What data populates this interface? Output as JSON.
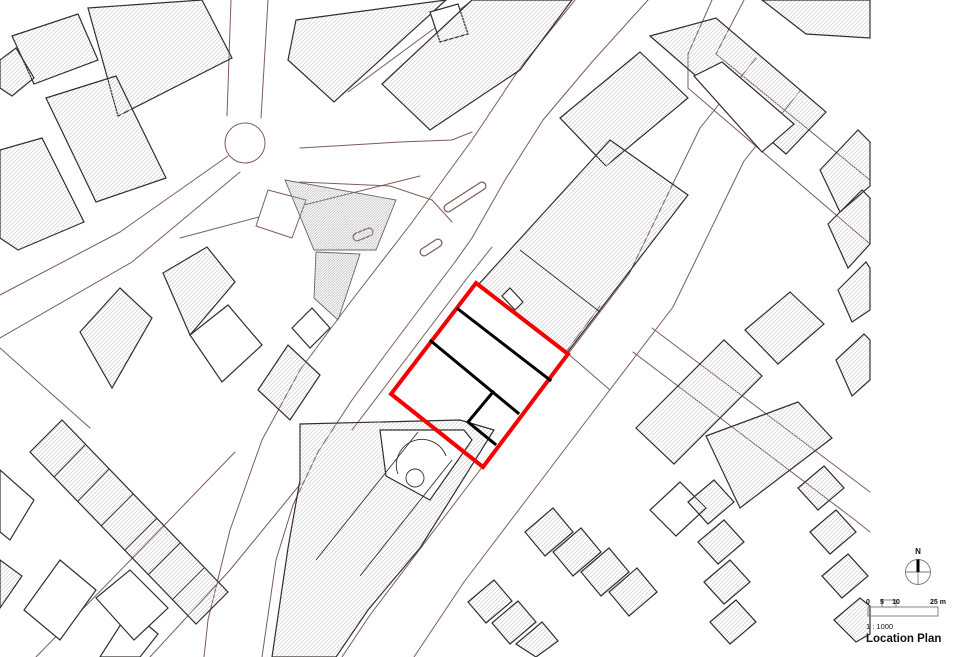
{
  "legend": {
    "north_label": "N",
    "ticks": [
      "0",
      "5",
      "10"
    ],
    "unit": "25 m",
    "ratio": "1 : 1000",
    "title": "Location Plan"
  },
  "site": {
    "boundary_color": "#f40000",
    "division_color": "#000000"
  },
  "map": {
    "building_outline_color": "#332e2e",
    "parcel_line_color": "#7d5c56",
    "shapes": [
      {
        "n": "road-main-nw-edge",
        "t": "pl",
        "c": "p",
        "p": "575,0 520,68 472,140 410,225 352,300 300,370 262,440 230,530 208,620 204,657"
      },
      {
        "n": "road-main-se-edge",
        "t": "pl",
        "c": "p",
        "p": "648,0 592,62 543,120 505,180 472,238 455,262 430,295 385,355 352,400 318,452 293,505 276,560 262,657"
      },
      {
        "n": "pavement-nw-of-site",
        "t": "pl",
        "c": "p",
        "p": "492,247 468,277 384,388 352,430"
      },
      {
        "n": "road-se-nw-edge",
        "t": "pl",
        "c": "p",
        "p": "756,58 700,128 629,274 568,354 483,466 420,549 370,615 342,657"
      },
      {
        "n": "road-se-se-edge",
        "t": "pl",
        "c": "p",
        "p": "800,91 744,161 673,307 612,387 527,499 464,582 414,657"
      },
      {
        "n": "road-ne-cross-edge-a",
        "t": "pl",
        "c": "p",
        "p": "744,0 716,54 870,180"
      },
      {
        "n": "road-ne-cross-edge-b",
        "t": "pl",
        "c": "p",
        "p": "712,0 688,54 688,88 870,244"
      },
      {
        "n": "road-mid-cross-edge-a",
        "t": "pl",
        "c": "p",
        "p": "652,328 870,492"
      },
      {
        "n": "road-mid-cross-edge-b",
        "t": "pl",
        "c": "p",
        "p": "633,352 855,520 870,532"
      },
      {
        "n": "road-roundabout-arm-e-a",
        "t": "pl",
        "c": "p",
        "p": "300,148 400,142 452,140 472,132"
      },
      {
        "n": "road-roundabout-arm-e-b",
        "t": "pl",
        "c": "p",
        "p": "300,182 390,186 432,200 452,222"
      },
      {
        "n": "road-roundabout-arm-n-a",
        "t": "pl",
        "c": "p",
        "p": "231,0 227,116"
      },
      {
        "n": "road-roundabout-arm-n-b",
        "t": "pl",
        "c": "p",
        "p": "268,0 261,118"
      },
      {
        "n": "road-roundabout-arm-sw-a",
        "t": "pl",
        "c": "p",
        "p": "228,156 120,232 0,295"
      },
      {
        "n": "road-roundabout-arm-sw-b",
        "t": "pl",
        "c": "p",
        "p": "240,172 132,262 0,338"
      },
      {
        "n": "roundabout-circle",
        "t": "c",
        "c": "p",
        "p": "245,143,20"
      },
      {
        "n": "parcel-line-bl-a",
        "t": "pl",
        "c": "p",
        "p": "0,348 90,428"
      },
      {
        "n": "parcel-line-bl-b",
        "t": "pl",
        "c": "p",
        "p": "36,657 150,540 235,452"
      },
      {
        "n": "parcel-line-bl-c",
        "t": "pl",
        "c": "p",
        "p": "150,657 230,570 302,482"
      },
      {
        "n": "parcel-line-mid",
        "t": "pl",
        "c": "p",
        "p": "180,238 300,206 420,176"
      },
      {
        "n": "parcel-line-topcenter",
        "t": "pl",
        "c": "p",
        "p": "348,92 470,2"
      },
      {
        "n": "parcel-line-ne",
        "t": "pl",
        "c": "p",
        "p": "600,306 566,352 610,390"
      },
      {
        "n": "parcel-plot-near-roundabout",
        "t": "pg",
        "c": "pf",
        "p": "268,190 306,200 292,238 256,226"
      },
      {
        "n": "traffic-island-a-outline",
        "t": "pa",
        "c": "pillo",
        "p": "M448,208 L482,186"
      },
      {
        "n": "traffic-island-a-fill",
        "t": "pa",
        "c": "pilli",
        "p": "M448,208 L482,186"
      },
      {
        "n": "traffic-island-b-outline",
        "t": "pa",
        "c": "pillo",
        "p": "M424,252 L438,243"
      },
      {
        "n": "traffic-island-b-fill",
        "t": "pa",
        "c": "pilli",
        "p": "M424,252 L438,243"
      },
      {
        "n": "traffic-island-c-outline",
        "t": "pa",
        "c": "pillo",
        "p": "M357,237 L369,232"
      },
      {
        "n": "traffic-island-c-fill",
        "t": "pa",
        "c": "pilli",
        "p": "M357,237 L369,232"
      },
      {
        "n": "green-blob-upper",
        "t": "pg",
        "c": "d",
        "p": "285,180 396,200 376,250 314,250"
      },
      {
        "n": "green-blob-tail",
        "t": "pg",
        "c": "d",
        "p": "316,252 360,254 338,320 314,298"
      },
      {
        "n": "building-tl-1",
        "t": "pg",
        "c": "b",
        "p": "88,8 202,0 232,58 118,116"
      },
      {
        "n": "building-tl-2",
        "t": "pg",
        "c": "b",
        "p": "12,36 78,14 98,60 34,84"
      },
      {
        "n": "building-tl-3",
        "t": "pg",
        "c": "b",
        "p": "46,98 116,76 166,178 96,202"
      },
      {
        "n": "building-tl-4",
        "t": "pg",
        "c": "b",
        "p": "0,150 42,138 84,222 18,250 0,238"
      },
      {
        "n": "building-tl-5",
        "t": "pg",
        "c": "b",
        "p": "0,60 16,48 34,78 12,96 0,88"
      },
      {
        "n": "building-tc-left",
        "t": "pg",
        "c": "b",
        "p": "296,20 446,0 334,102 288,60"
      },
      {
        "n": "building-tc-left-annex",
        "t": "pg",
        "c": "w",
        "p": "430,12 458,4 468,34 440,42"
      },
      {
        "n": "building-tc-right",
        "t": "pg",
        "c": "b",
        "p": "472,0 572,0 520,70 430,130 382,84"
      },
      {
        "n": "building-ne-upper",
        "t": "pg",
        "c": "b",
        "p": "560,118 640,52 688,98 606,166"
      },
      {
        "n": "building-tr-slab",
        "t": "pg",
        "c": "b",
        "p": "650,36 716,18 826,112 786,154"
      },
      {
        "n": "building-tr-inner-white",
        "t": "pg",
        "c": "w",
        "p": "694,76 722,62 794,124 762,152"
      },
      {
        "n": "building-tr-corner",
        "t": "pg",
        "c": "b",
        "p": "762,0 870,0 870,38 806,34"
      },
      {
        "n": "building-right-strip-1",
        "t": "pg",
        "c": "b",
        "p": "820,170 858,130 870,142 870,186 840,212"
      },
      {
        "n": "building-right-strip-2",
        "t": "pg",
        "c": "b",
        "p": "828,224 862,190 870,198 870,244 848,268"
      },
      {
        "n": "building-right-strip-3",
        "t": "pg",
        "c": "b",
        "p": "838,290 866,262 870,268 870,310 852,322"
      },
      {
        "n": "building-ne-of-site",
        "t": "pg",
        "c": "b",
        "p": "610,140 688,195 567,353 478,285"
      },
      {
        "n": "building-ml-big",
        "t": "pg",
        "c": "b",
        "p": "80,332 120,288 152,318 112,388"
      },
      {
        "n": "building-ml-2",
        "t": "pg",
        "c": "b",
        "p": "163,273 207,247 235,282 190,335"
      },
      {
        "n": "building-ml-3",
        "t": "pg",
        "c": "w",
        "p": "190,335 228,305 262,345 222,382"
      },
      {
        "n": "building-ml-4",
        "t": "pg",
        "c": "b",
        "p": "258,390 288,345 320,375 290,420"
      },
      {
        "n": "building-ml-5",
        "t": "pg",
        "c": "w",
        "p": "292,328 312,308 330,328 310,348"
      },
      {
        "n": "building-sw-of-site",
        "t": "pg",
        "c": "b",
        "p": "300,424 460,420 494,430 420,548 368,610 336,657 272,657 288,548 300,480"
      },
      {
        "n": "building-sw-courtyard",
        "t": "pg",
        "c": "w",
        "p": "380,430 464,430 472,440 430,500 386,476"
      },
      {
        "n": "terrace-row",
        "t": "pg",
        "c": "b",
        "p": "30,452 62,420 228,592 196,624"
      },
      {
        "n": "terrace-div-1",
        "t": "ln",
        "c": "t",
        "p": "85,445 54,477"
      },
      {
        "n": "terrace-div-2",
        "t": "ln",
        "c": "t",
        "p": "109,469 78,501"
      },
      {
        "n": "terrace-div-3",
        "t": "ln",
        "c": "t",
        "p": "133,494 101,526"
      },
      {
        "n": "terrace-div-4",
        "t": "ln",
        "c": "t",
        "p": "157,518 125,550"
      },
      {
        "n": "terrace-div-5",
        "t": "ln",
        "c": "t",
        "p": "180,543 148,575"
      },
      {
        "n": "terrace-div-6",
        "t": "ln",
        "c": "t",
        "p": "204,568 172,600"
      },
      {
        "n": "building-bl-1",
        "t": "pg",
        "c": "w",
        "p": "0,470 34,500 10,540 0,532"
      },
      {
        "n": "building-bl-2",
        "t": "pg",
        "c": "w",
        "p": "60,560 96,590 60,640 24,610"
      },
      {
        "n": "building-bl-3",
        "t": "pg",
        "c": "w",
        "p": "100,657 130,610 158,634 140,657"
      },
      {
        "n": "building-bl-4",
        "t": "pg",
        "c": "b",
        "p": "0,560 22,576 0,608"
      },
      {
        "n": "building-bl-5",
        "t": "pg",
        "c": "w",
        "p": "96,598 130,570 168,608 134,640"
      },
      {
        "n": "building-rm-cross-a",
        "t": "pg",
        "c": "b",
        "p": "636,428 724,340 762,376 674,464"
      },
      {
        "n": "building-rm-cross-b",
        "t": "pg",
        "c": "b",
        "p": "706,436 798,402 832,438 740,508"
      },
      {
        "n": "building-rm-right",
        "t": "pg",
        "c": "b",
        "p": "836,360 864,334 870,340 870,380 852,396"
      },
      {
        "n": "building-rm-small",
        "t": "pg",
        "c": "w",
        "p": "650,510 680,482 706,508 676,536"
      },
      {
        "n": "building-rm-upper",
        "t": "pg",
        "c": "b",
        "p": "745,330 790,292 824,324 778,364"
      },
      {
        "n": "house-row1-1",
        "t": "pg",
        "c": "b",
        "p": "525,532 553,508 573,532 545,556"
      },
      {
        "n": "house-row1-2",
        "t": "pg",
        "c": "b",
        "p": "553,552 581,528 601,552 573,576"
      },
      {
        "n": "house-row1-3",
        "t": "pg",
        "c": "b",
        "p": "581,572 609,548 629,572 601,596"
      },
      {
        "n": "house-row1-4",
        "t": "pg",
        "c": "b",
        "p": "609,592 637,568 657,592 629,616"
      },
      {
        "n": "house-row2-1",
        "t": "pg",
        "c": "b",
        "p": "468,602 494,580 512,601 486,623"
      },
      {
        "n": "house-row2-2",
        "t": "pg",
        "c": "b",
        "p": "492,623 518,601 536,622 510,644"
      },
      {
        "n": "house-row2-3",
        "t": "pg",
        "c": "b",
        "p": "516,644 542,622 558,641 536,657"
      },
      {
        "n": "house-col1-1",
        "t": "pg",
        "c": "b",
        "p": "688,502 714,480 734,502 708,524"
      },
      {
        "n": "house-col1-2",
        "t": "pg",
        "c": "b",
        "p": "698,542 724,520 744,542 718,564"
      },
      {
        "n": "house-col1-3",
        "t": "pg",
        "c": "b",
        "p": "704,582 730,560 750,582 724,604"
      },
      {
        "n": "house-col1-4",
        "t": "pg",
        "c": "b",
        "p": "710,622 736,600 756,622 730,644"
      },
      {
        "n": "house-col2-1",
        "t": "pg",
        "c": "b",
        "p": "798,488 824,466 844,488 818,510"
      },
      {
        "n": "house-col2-2",
        "t": "pg",
        "c": "b",
        "p": "810,532 836,510 856,532 830,554"
      },
      {
        "n": "house-col2-3",
        "t": "pg",
        "c": "b",
        "p": "822,576 848,554 868,576 842,598"
      },
      {
        "n": "house-col2-4",
        "t": "pg",
        "c": "b",
        "p": "834,620 860,598 870,606 870,634 856,642"
      },
      {
        "n": "sw-division-1",
        "t": "ln",
        "c": "t",
        "p": "452,460 360,576"
      },
      {
        "n": "sw-division-2",
        "t": "ln",
        "c": "t",
        "p": "418,432 316,560"
      },
      {
        "n": "ne-division",
        "t": "ln",
        "c": "t",
        "p": "520,250 600,312"
      },
      {
        "n": "sw-canopy-arc",
        "t": "pa",
        "c": "t",
        "p": "M398,474 A25,25 0 1 1 446,456"
      },
      {
        "n": "sw-circle-feature",
        "t": "c",
        "c": "t",
        "p": "415,478,9"
      },
      {
        "n": "site-edge-tab",
        "t": "pg",
        "c": "w",
        "p": "502,296 510,288 523,302 515,310"
      },
      {
        "n": "site-boundary",
        "t": "pg",
        "c": "red",
        "p": "476,283 568,354 483,467 391,394"
      },
      {
        "n": "site-division-a",
        "t": "ln",
        "c": "blk",
        "p": "458,309 550,380"
      },
      {
        "n": "site-division-b",
        "t": "ln",
        "c": "blk",
        "p": "431,341 518,413"
      },
      {
        "n": "site-division-step",
        "t": "pl",
        "c": "blk",
        "p": "493,392 468,422 495,444"
      }
    ]
  }
}
